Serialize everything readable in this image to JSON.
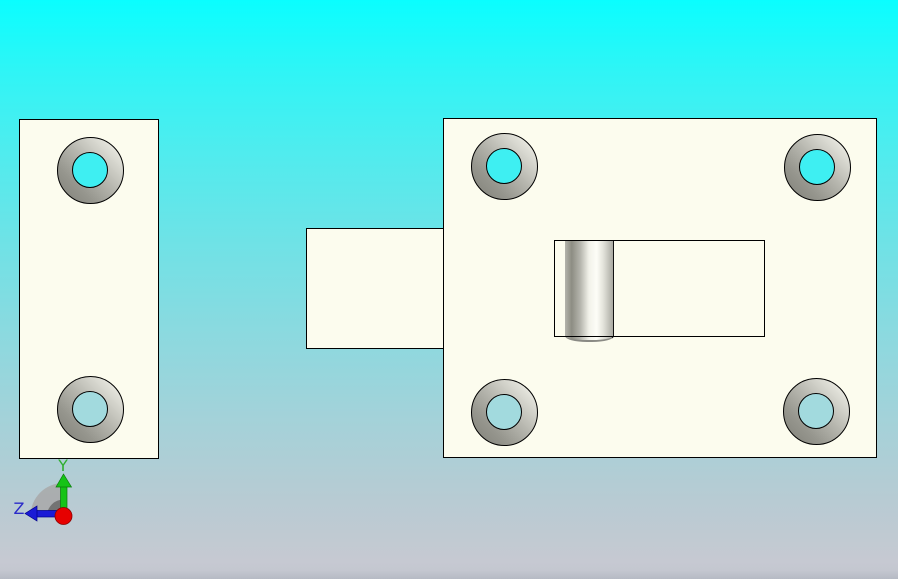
{
  "viewport": {
    "axis_triad": {
      "y_label": "Y",
      "z_label": "Z",
      "y_axis_color": "#16c316",
      "z_axis_color": "#1a1ad6",
      "origin_dot_color": "#e60000",
      "rotation_fan_outer_color": "#a8a8a8",
      "rotation_fan_inner_color": "#6d6d6d"
    },
    "colors": {
      "background_top": "#0afeff",
      "background_bottom": "#c6c9d2",
      "part_fill": "#fcfcee",
      "edge_outline": "#000000",
      "countersink_shadow": "#7f7f77",
      "countersink_highlight": "#f0f0e8",
      "hole_show_through_top": "#3eeff2",
      "hole_show_through_bottom": "#a2dade",
      "bolt_knob_highlight": "#fdfdf7",
      "bolt_knob_shadow": "#8d8d83"
    },
    "part_counts": {
      "countersunk_holes_left_plate": 2,
      "countersunk_holes_latch_body": 4
    }
  }
}
